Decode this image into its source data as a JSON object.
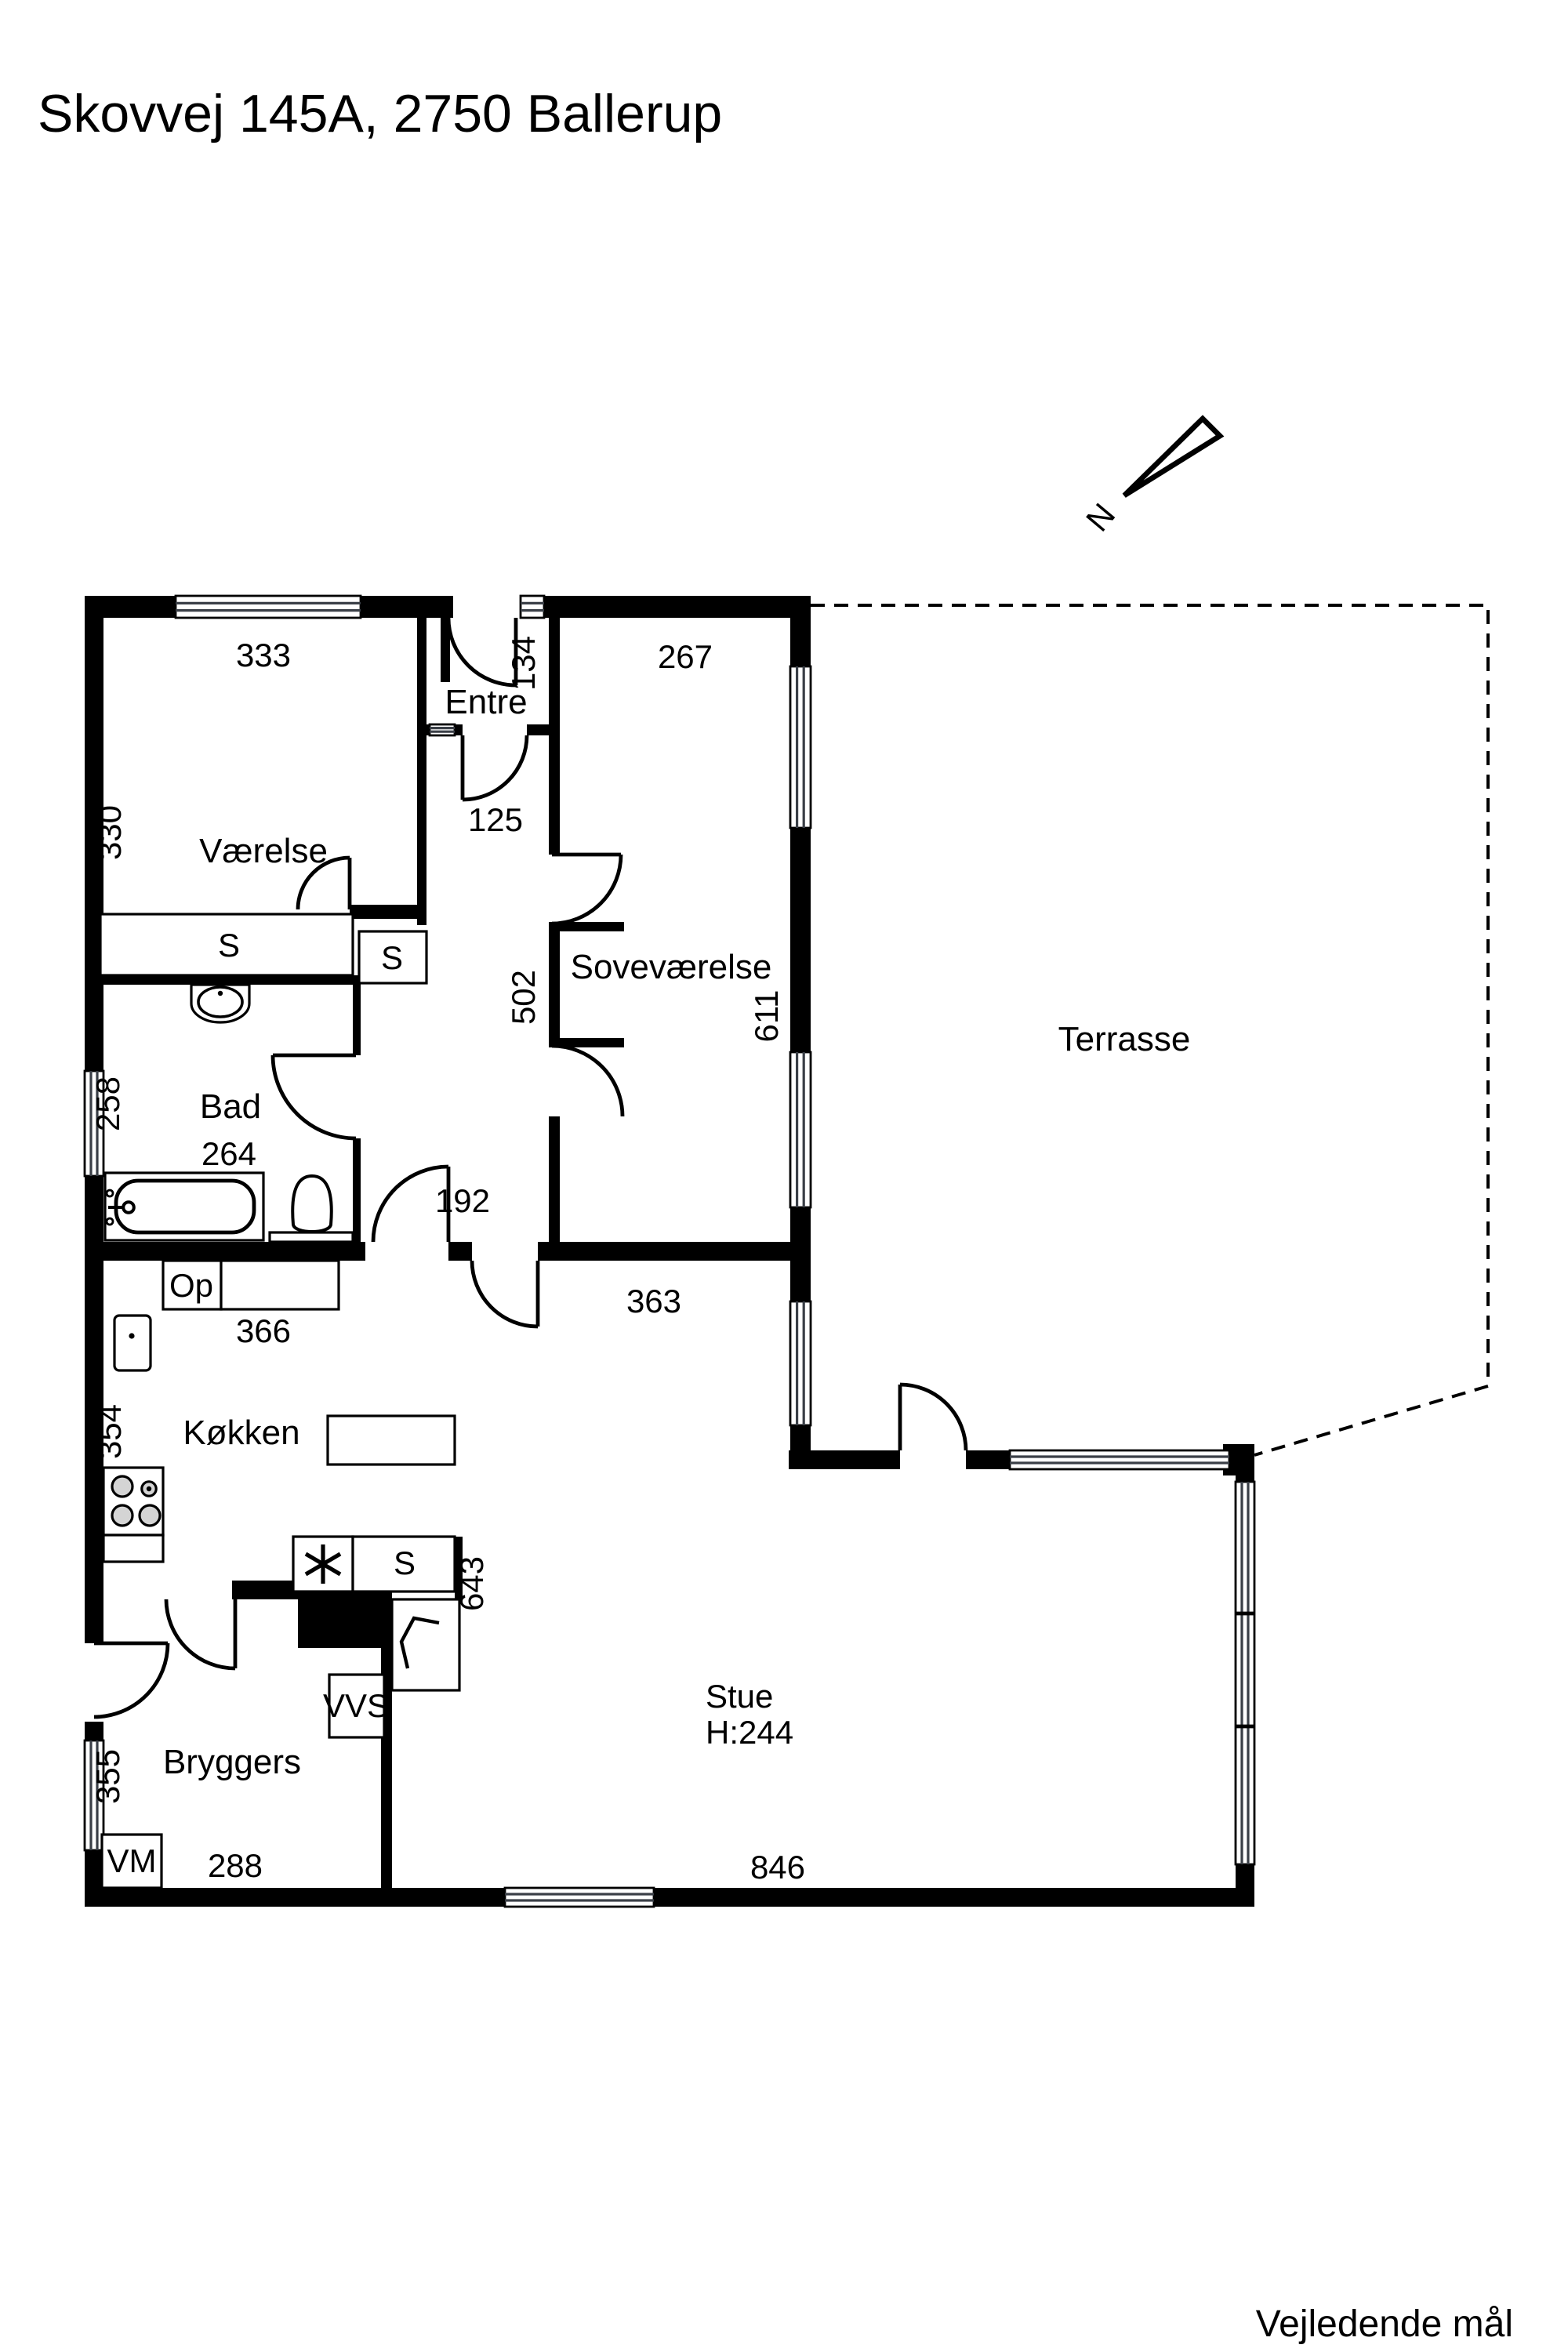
{
  "title": "Skovvej 145A, 2750 Ballerup",
  "footer_note": "Vejledende mål",
  "compass": {
    "north_label": "N"
  },
  "rooms": {
    "vaerelse": {
      "label": "Værelse"
    },
    "entre": {
      "label": "Entre"
    },
    "sovevaerelse": {
      "label": "Soveværelse"
    },
    "terrasse": {
      "label": "Terrasse"
    },
    "bad": {
      "label": "Bad"
    },
    "koekken": {
      "label": "Køkken"
    },
    "stue": {
      "label": "Stue",
      "ceiling_height": "H:244"
    },
    "bryggers": {
      "label": "Bryggers"
    }
  },
  "dimensions": {
    "vaerelse_width": "333",
    "vaerelse_depth": "330",
    "sovevaerelse_width": "267",
    "entre_depth": "134",
    "entre_passage": "125",
    "sovevaerelse_depth": "502",
    "sovevaerelse_east": "611",
    "bad_window_side": "258",
    "bad_width": "264",
    "corridor_width": "192",
    "sovevaerelse_bottom": "363",
    "koekken_top": "366",
    "koekken_side": "354",
    "koekken_east": "643",
    "bryggers_window_side": "355",
    "bryggers_width": "288",
    "stue_width": "846"
  },
  "fixtures": {
    "closet_big": "S",
    "closet_small": "S",
    "closet_kitchen": "S",
    "oven_cabinet": "Op",
    "vvs_unit": "VVS",
    "washing_machine": "VM"
  }
}
